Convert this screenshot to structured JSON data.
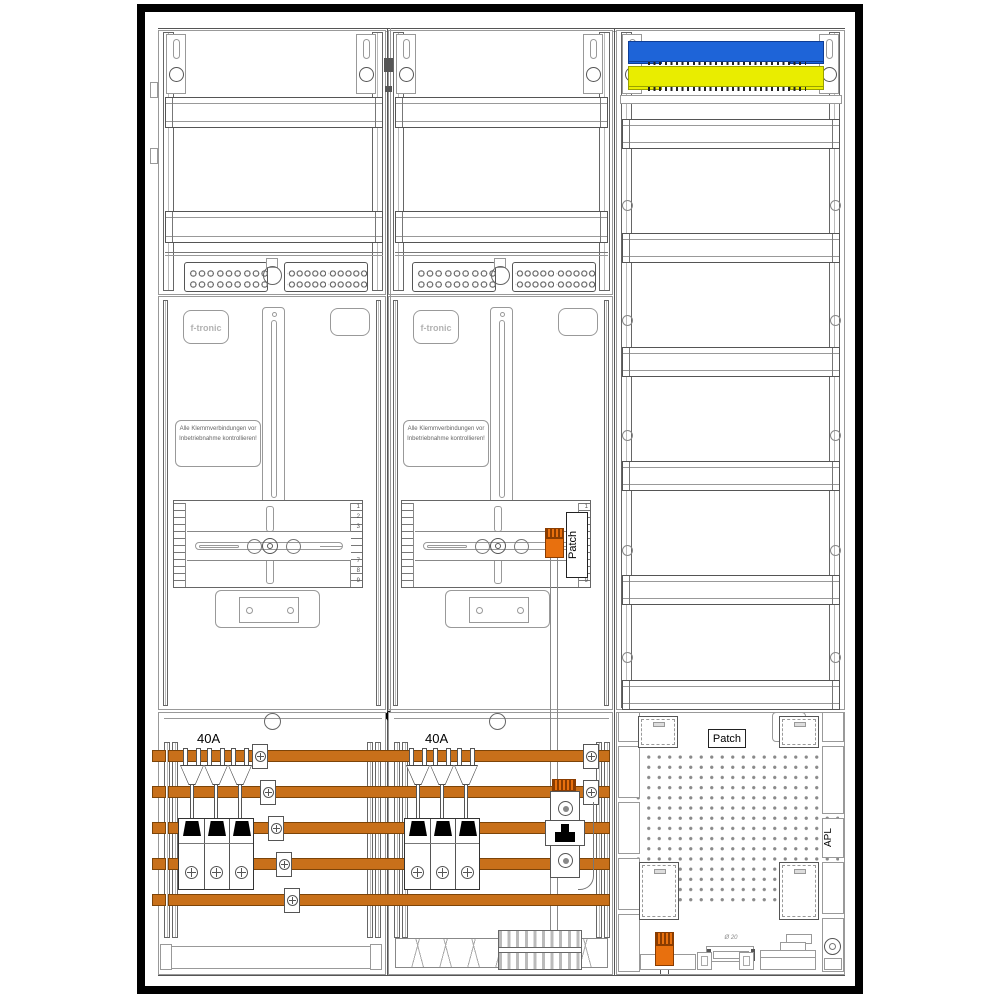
{
  "drawing": {
    "fields": [
      {
        "name": "meter-field-1",
        "logo": "f-tronic",
        "warning": "Alle Klemmverbindungen vor Inbetriebnahme kontrollieren!",
        "breaker_rating": "40A"
      },
      {
        "name": "meter-field-2",
        "logo": "f-tronic",
        "warning": "Alle Klemmverbindungen vor Inbetriebnahme kontrollieren!",
        "breaker_rating": "40A",
        "patch_label": "Patch"
      },
      {
        "name": "distribution-multimedia-field",
        "patch_label": "Patch",
        "apl_label": "APL",
        "conduit_label": "Ø 20"
      }
    ],
    "ruler": {
      "top": [
        "1",
        "2",
        "3"
      ],
      "bottom": [
        "7",
        "8",
        "9"
      ]
    },
    "colors": {
      "busbar_copper": "#C8701A",
      "neutral_rail_blue": "#1E64D8",
      "pe_rail_yellow": "#E9ED00",
      "component_orange": "#E8700E",
      "line_gray": "#555555"
    }
  }
}
